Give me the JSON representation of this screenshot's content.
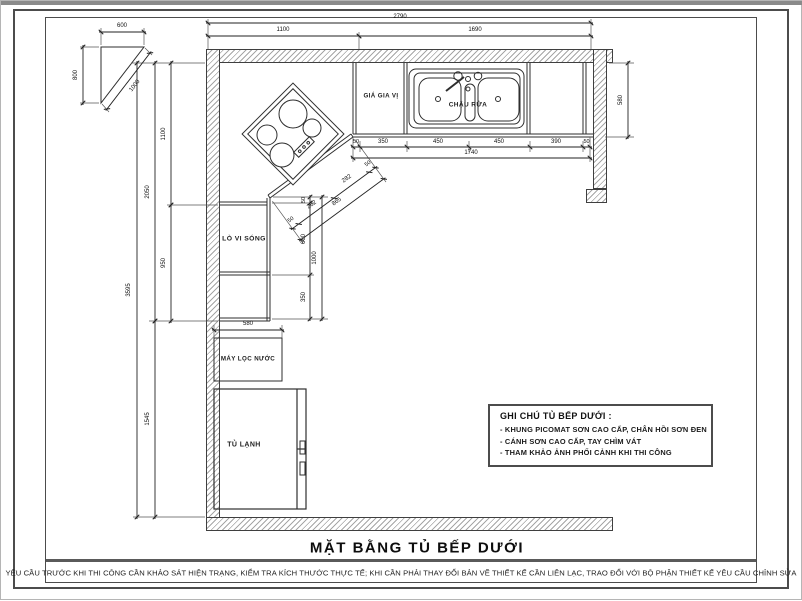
{
  "title": "MẶT BẰNG TỦ BẾP DƯỚI",
  "footer": "YÊU CẦU TRƯỚC KHI THI CÔNG CẦN KHẢO SÁT HIỆN TRẠNG, KIỂM TRA KÍCH THƯỚC THỰC TẾ; KHI CẦN PHẢI THAY ĐỔI BẢN VẼ THIẾT KẾ CẦN LIÊN LẠC, TRAO ĐỔI VỚI BỘ PHẬN THIẾT KẾ YÊU CẦU CHỈNH SỬA",
  "labels": {
    "spice_rack": "GIÁ GIA VỊ",
    "sink": "CHẬU RỬA",
    "microwave": "LÒ VI SÓNG",
    "water_filter": "MÁY LỌC NƯỚC",
    "fridge": "TỦ LẠNH"
  },
  "notes": {
    "title": "GHI CHÚ TỦ BẾP DƯỚI :",
    "items": [
      "- KHUNG PICOMAT SƠN CAO CẤP, CHÂN HỒI SƠN ĐEN",
      "- CÁNH SƠN CAO CẤP, TAY CHÌM VÁT",
      "- THAM KHẢO ẢNH PHỐI CẢNH KHI THI CÔNG"
    ]
  },
  "dims": {
    "top_total": "2790",
    "top_left": "1100",
    "top_right": "1690",
    "tri_w": "600",
    "tri_h": "800",
    "tri_d": "1000",
    "left_outer": "3595",
    "left_mid_upper": "2050",
    "left_mid_lower": "1545",
    "left_inner_upper": "1100",
    "left_inner_lower": "950",
    "sink_chain": [
      "50",
      "350",
      "450",
      "450",
      "390",
      "50"
    ],
    "sink_total": "1740",
    "right_side": "580",
    "inner_v": [
      "50",
      "600",
      "350"
    ],
    "inner_v_total": "1000",
    "diag_chain": [
      "50",
      "282",
      "282",
      "50"
    ],
    "diag_total": "865",
    "water_filter_w": "580"
  },
  "colors": {
    "line": "#2e2e2e",
    "hatch": "#a6a6a6",
    "text": "#1a1a1a"
  }
}
